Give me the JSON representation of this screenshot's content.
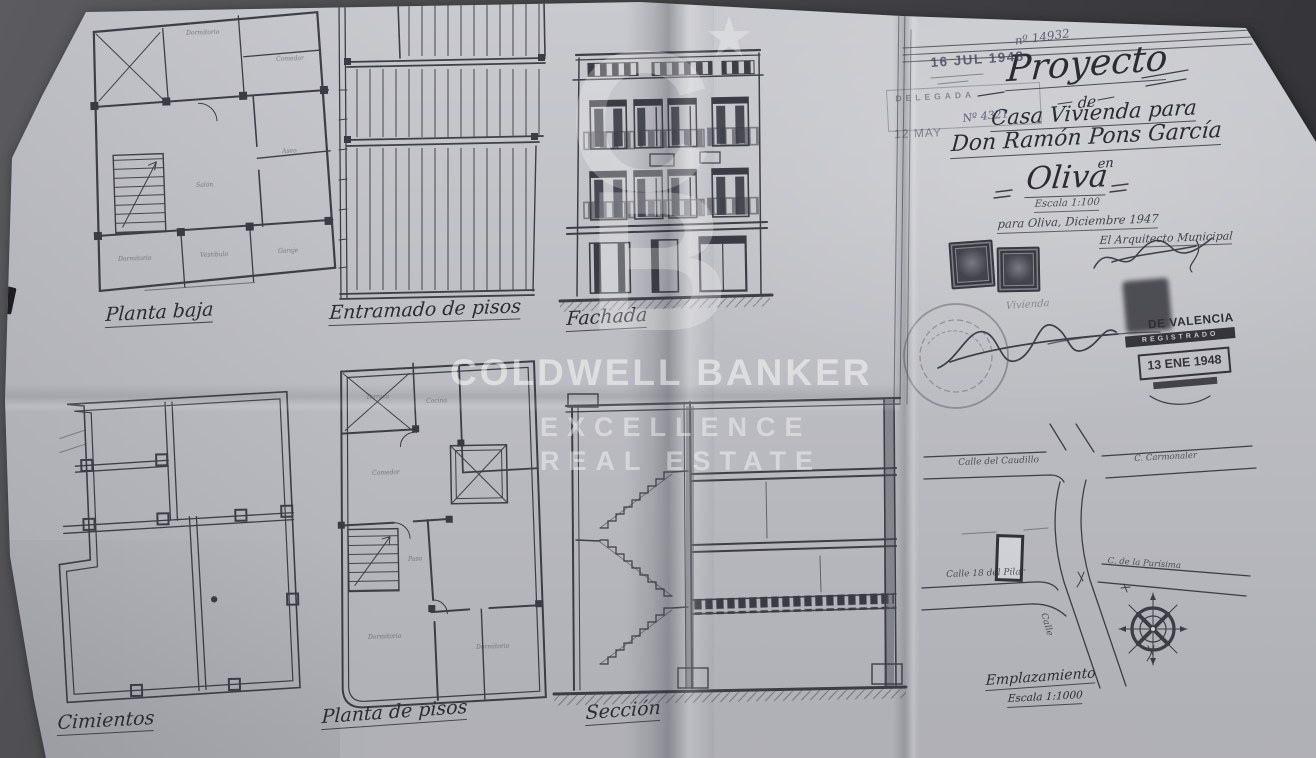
{
  "colors": {
    "paper": "#c6c7cc",
    "ink": "#33343b",
    "photo_bg": "#454549",
    "stamp_ink": "#26262c"
  },
  "watermark": {
    "monogram_c": "C",
    "monogram_b": "B",
    "star": "★",
    "line1": "COLDWELL BANKER",
    "line2": "EXCELLENCE",
    "line3": "REAL ESTATE"
  },
  "panels": {
    "planta_baja": {
      "label": "Planta baja",
      "rooms": {
        "r1": "Dormitorio",
        "r2": "Comedor",
        "r3": "Salón",
        "r4": "Aseo",
        "r5": "Dormitorio",
        "r6": "Vestíbulo",
        "r7": "Garaje"
      }
    },
    "entramado": {
      "label": "Entramado de pisos"
    },
    "fachada": {
      "label": "Fachada"
    },
    "cimientos": {
      "label": "Cimientos"
    },
    "planta_pisos": {
      "label": "Planta de pisos",
      "rooms": {
        "r1": "Terraza",
        "r2": "Cocina",
        "r3": "Comedor",
        "r4": "Paso",
        "r5": "Dormitorio",
        "r6": "Dormitorio"
      }
    },
    "seccion": {
      "label": "Sección"
    },
    "emplazamiento": {
      "label": "Emplazamiento",
      "scale": "Escala 1:1000",
      "streets": {
        "west": "Calle del Caudillo",
        "east": "C. Carmonaler",
        "southwest": "Calle 18 del Pilar",
        "southeast": "C. de la Purísima",
        "south": "Calle"
      }
    }
  },
  "title_block": {
    "project": "Proyecto",
    "de": "de",
    "line_vivienda": "Casa Vivienda para",
    "owner": "Don Ramón Pons García",
    "en": "en",
    "city": "Oliva",
    "scale": "Escala 1:100",
    "date_line": "para Oliva, Diciembre 1947",
    "architect": "El Arquitecto Municipal",
    "faint_note": "Vivienda"
  },
  "stamps": {
    "entry_date": "16 JUL 1948",
    "entry_number": "nº 14932",
    "mid_date": "12 MAY",
    "mid_number": "Nº 4321",
    "delegada": "DELEGADA",
    "delegada_top": "DELEGADA",
    "registry_org": "DE VALENCIA",
    "registry_action": "REGISTRADO",
    "registry_date": "13 ENE 1948"
  }
}
